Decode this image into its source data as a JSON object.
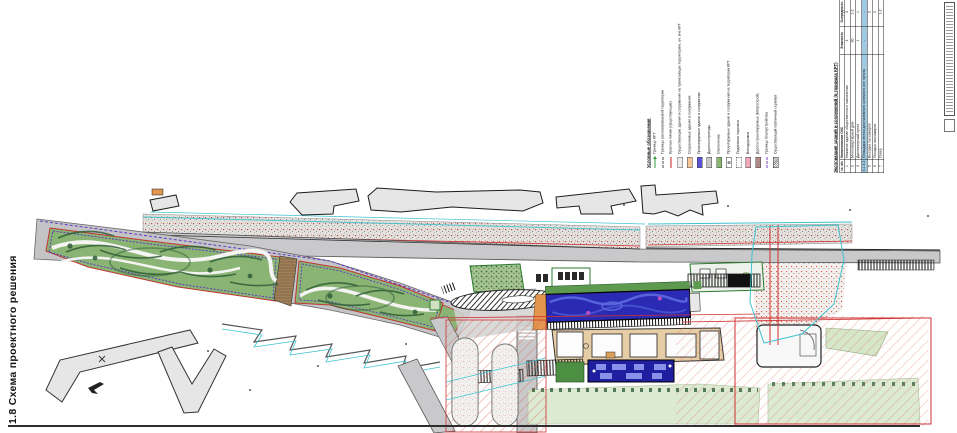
{
  "sheet": {
    "title": "1.8 Схема проектного решения"
  },
  "legend": {
    "title": "Условные обозначения",
    "items": [
      {
        "label": "Границы КРТ",
        "kind": "line-arrow",
        "color": "#2f9e41"
      },
      {
        "label": "Границы рассматриваемой территории",
        "kind": "dashdot",
        "color": "#444444"
      },
      {
        "label": "Красные линии (существующие)",
        "kind": "line",
        "color": "#cc1f1f"
      },
      {
        "label": "Существующие здания и сооружения на прилегающих территориях, уч. вне КРТ",
        "kind": "rect-outline",
        "color": "#ededed"
      },
      {
        "label": "Сохраняемые здания и сооружения",
        "kind": "rect",
        "color": "#f5c497"
      },
      {
        "label": "Проектируемые здания и сооружения",
        "kind": "rect",
        "color": "#5b52d6"
      },
      {
        "label": "Дороги и проезды",
        "kind": "rect",
        "color": "#c8c8c8"
      },
      {
        "label": "Озеленение",
        "kind": "rect",
        "color": "#8ab873"
      },
      {
        "label": "Проектируемые здания и сооружения на территории КРТ",
        "kind": "rect-symbol",
        "color": "#ffffff",
        "symbol": "⊗"
      },
      {
        "label": "Подземная парковка",
        "kind": "rect-dashed",
        "color": "#ffffff"
      },
      {
        "label": "Велодорожки",
        "kind": "rect",
        "color": "#efa8b7"
      },
      {
        "label": "Дороги проектируемые (Метрострой)",
        "kind": "rect",
        "color": "#b18a8a"
      },
      {
        "label": "Границы благоустройства",
        "kind": "dashdot",
        "color": "#7a3fc9"
      },
      {
        "label": "Существующий публичный сервитут",
        "kind": "rect-hatch",
        "color": "#bdbdbd"
      }
    ]
  },
  "explication": {
    "title": "Экспликация зданий и сооружений (в границах КРТ)",
    "columns": [
      "№ п/п",
      "Наименование ОКС",
      "Этажность",
      "Очередность"
    ],
    "rows": [
      {
        "num": "1",
        "name": "Нежилое здание общественного назначения",
        "floors": "4",
        "stage": "3",
        "highlight": false
      },
      {
        "num": "2",
        "name": "Многоквартирный дом",
        "floors": "30",
        "stage": "1-2",
        "highlight": false
      },
      {
        "num": "3",
        "name": "Диспетчерский пункт",
        "floors": "1",
        "stage": "1",
        "highlight": false
      },
      {
        "num": "4.1 4.2",
        "name": "Площадка отстоя для наземного конечного ост. пункта",
        "floors": "-",
        "stage": "-",
        "highlight": true
      },
      {
        "num": "5",
        "name": "Высадка пассажиров",
        "floors": "",
        "stage": "2",
        "highlight": false
      },
      {
        "num": "6",
        "name": "Посадка пассажиров",
        "floors": "",
        "stage": "2",
        "highlight": false
      },
      {
        "num": "7",
        "name": "Сквер",
        "floors": "",
        "stage": "1-2",
        "highlight": false
      }
    ],
    "highlight_color": "#9fc9e2"
  },
  "plan": {
    "colors": {
      "park_green": "#8ab473",
      "tree_green": "#2f5e38",
      "lawn_green": "#dcead3",
      "road_gray": "#c9c9cb",
      "building_gray": "#e6e6e6",
      "platform_blue": "#2a2ab4",
      "platform_blue_light": "#5b66dd",
      "deep_blue": "#1e1e9e",
      "saved_orange": "#e2954e",
      "beige": "#e7cda6",
      "red_line": "#d03030",
      "cyan_line": "#3fc3ce",
      "purple_line": "#6038c8"
    }
  }
}
